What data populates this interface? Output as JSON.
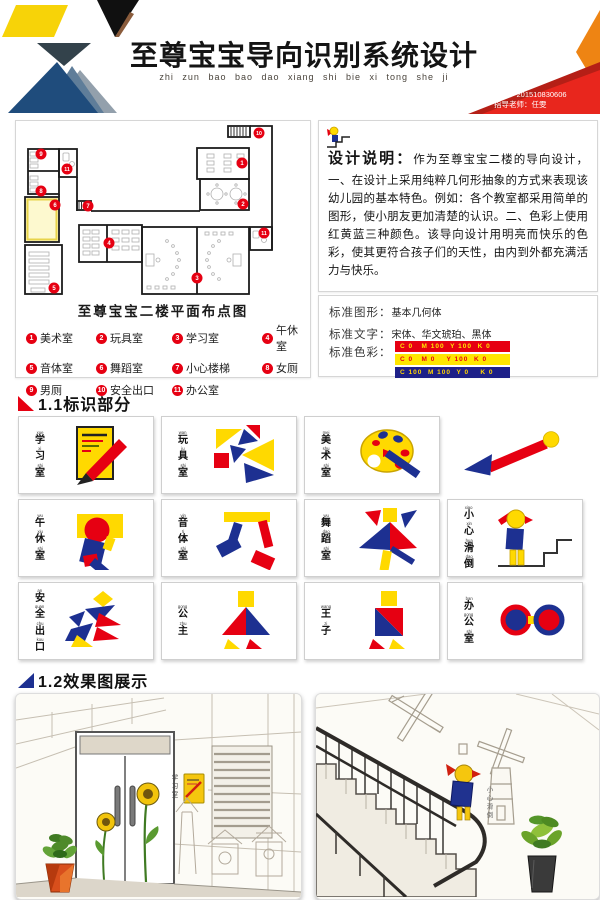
{
  "header": {
    "title": "至尊宝宝导向识别系统设计",
    "pinyin": "zhi zun bao bao dao xiang shi bie xi tong she ji",
    "name": "姓名：莫倩",
    "student_id": "学号：201510830606",
    "teacher": "指导老师：任雯"
  },
  "floorplan": {
    "caption": "至尊宝宝二楼平面布点图",
    "markers": [
      "1",
      "2",
      "3",
      "4",
      "5",
      "6",
      "7",
      "8",
      "9",
      "10",
      "11",
      "11"
    ],
    "legend": [
      {
        "num": "1",
        "label": "美术室"
      },
      {
        "num": "2",
        "label": "玩具室"
      },
      {
        "num": "3",
        "label": "学习室"
      },
      {
        "num": "4",
        "label": "午休室"
      },
      {
        "num": "5",
        "label": "音体室"
      },
      {
        "num": "6",
        "label": "舞蹈室"
      },
      {
        "num": "7",
        "label": "小心楼梯"
      },
      {
        "num": "8",
        "label": "女厕"
      },
      {
        "num": "9",
        "label": "男厕"
      },
      {
        "num": "10",
        "label": "安全出口"
      },
      {
        "num": "11",
        "label": "办公室"
      }
    ]
  },
  "description": {
    "heading": "设计说明：",
    "body": "作为至尊宝宝二楼的导向设计，一、在设计上采用纯粹几何形抽象的方式来表现该幼儿园的基本特色。例如：各个教室都采用简单的图形，使小朋友更加清楚的认识。二、色彩上使用红黄蓝三种颜色。该导向设计用明亮而快乐的色彩，使其更符合孩子们的天性，由内到外都充满活力与快乐。"
  },
  "standards": {
    "graphic_label": "标准图形：",
    "graphic_value": "基本几何体",
    "font_label": "标准文字：",
    "font_value": "宋体、华文琥珀、黑体",
    "color_label": "标准色彩：",
    "swatches": [
      {
        "cmyk": "C 0   M 100  Y 100  K 0",
        "bg": "#e60012"
      },
      {
        "cmyk": "C 0   M 0    Y 100  K 0",
        "bg": "#ffe600"
      },
      {
        "cmyk": "C 100  M 100  Y 0    K 0",
        "bg": "#1d2088"
      }
    ]
  },
  "sections": {
    "signs": "1.1标识部分",
    "renders": "1.2效果图展示"
  },
  "signs": [
    {
      "icon": "study-sign",
      "pinyin": [
        "xue",
        "xi",
        "shi"
      ],
      "chars": [
        "学",
        "习",
        "室"
      ]
    },
    {
      "icon": "toy-sign",
      "pinyin": [
        "wan",
        "ju",
        "shi"
      ],
      "chars": [
        "玩",
        "具",
        "室"
      ]
    },
    {
      "icon": "art-sign",
      "pinyin": [
        "mei",
        "shu",
        "shi"
      ],
      "chars": [
        "美",
        "术",
        "室"
      ]
    },
    {
      "icon": "direction-arrow",
      "pinyin": [],
      "chars": []
    },
    {
      "icon": "nap-sign",
      "pinyin": [
        "wu",
        "xiu",
        "shi"
      ],
      "chars": [
        "午",
        "休",
        "室"
      ]
    },
    {
      "icon": "music-sign",
      "pinyin": [
        "yin",
        "ti",
        "shi"
      ],
      "chars": [
        "音",
        "体",
        "室"
      ]
    },
    {
      "icon": "dance-sign",
      "pinyin": [
        "wu",
        "dao",
        "shi"
      ],
      "chars": [
        "舞",
        "蹈",
        "室"
      ]
    },
    {
      "icon": "caution-sign",
      "pinyin": [
        "xiao",
        "xin",
        "hua",
        "dao"
      ],
      "chars": [
        "小",
        "心",
        "滑",
        "倒"
      ]
    },
    {
      "icon": "exit-sign",
      "pinyin": [
        "an",
        "quan",
        "chu",
        "kou"
      ],
      "chars": [
        "安",
        "全",
        "出",
        "口"
      ]
    },
    {
      "icon": "princess-sign",
      "pinyin": [
        "gong",
        "zhu"
      ],
      "chars": [
        "公",
        "主"
      ]
    },
    {
      "icon": "prince-sign",
      "pinyin": [
        "wang",
        "zi"
      ],
      "chars": [
        "王",
        "子"
      ]
    },
    {
      "icon": "office-sign",
      "pinyin": [
        "ban",
        "gong",
        "shi"
      ],
      "chars": [
        "办",
        "公",
        "室"
      ]
    }
  ],
  "renders": {
    "left_sign": "学习室",
    "right_sign": "小心滑倒"
  },
  "colors": {
    "red": "#e60012",
    "yellow": "#ffd900",
    "blue": "#1d3091"
  }
}
